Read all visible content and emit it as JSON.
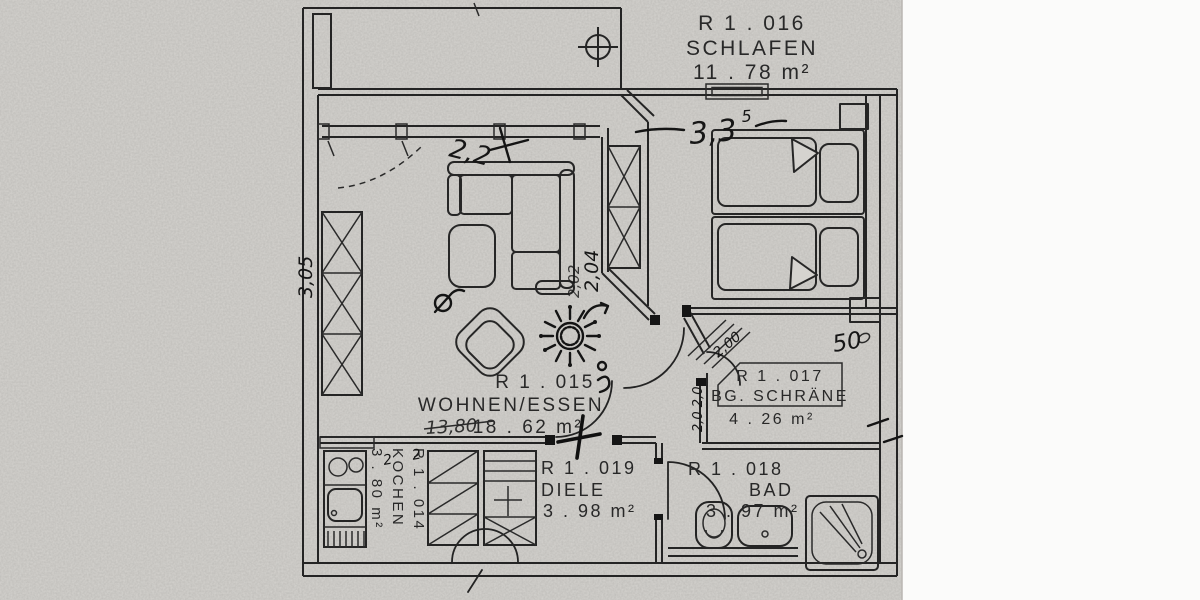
{
  "colors": {
    "paper": "#d5d3cf",
    "ink": "#242424",
    "page_white": "#fbfbfa"
  },
  "plan": {
    "rooms": [
      {
        "id": "R 1 . 016",
        "name": "SCHLAFEN",
        "area": "11 . 78 m²"
      },
      {
        "id": "R 1 . 015",
        "name": "WOHNEN/ESSEN",
        "area": "18 . 62 m²"
      },
      {
        "id": "R 1 . 017",
        "name": "BG. SCHRÄNE",
        "area": "4 . 26 m²"
      },
      {
        "id": "R 1 . 018",
        "name": "BAD",
        "area": "3 . 97 m²"
      },
      {
        "id": "R 1 . 019",
        "name": "DIELE",
        "area": "3 . 98 m²"
      },
      {
        "id": "R 1 . 014",
        "name": "KOCHEN",
        "area": "3 . 80 m²"
      }
    ],
    "annotations": {
      "top_width": "3,3",
      "top_width_sup": "5",
      "sofa_width": "2,2",
      "wall_height": "2,04",
      "wall_height_b": "2,02",
      "left_height": "3,05",
      "living_width": "13,80",
      "right_width": "50",
      "schraenke_diag": "2,00",
      "schraenke_small": "2,0 2,0",
      "kitchen_marks": "2 2"
    }
  }
}
